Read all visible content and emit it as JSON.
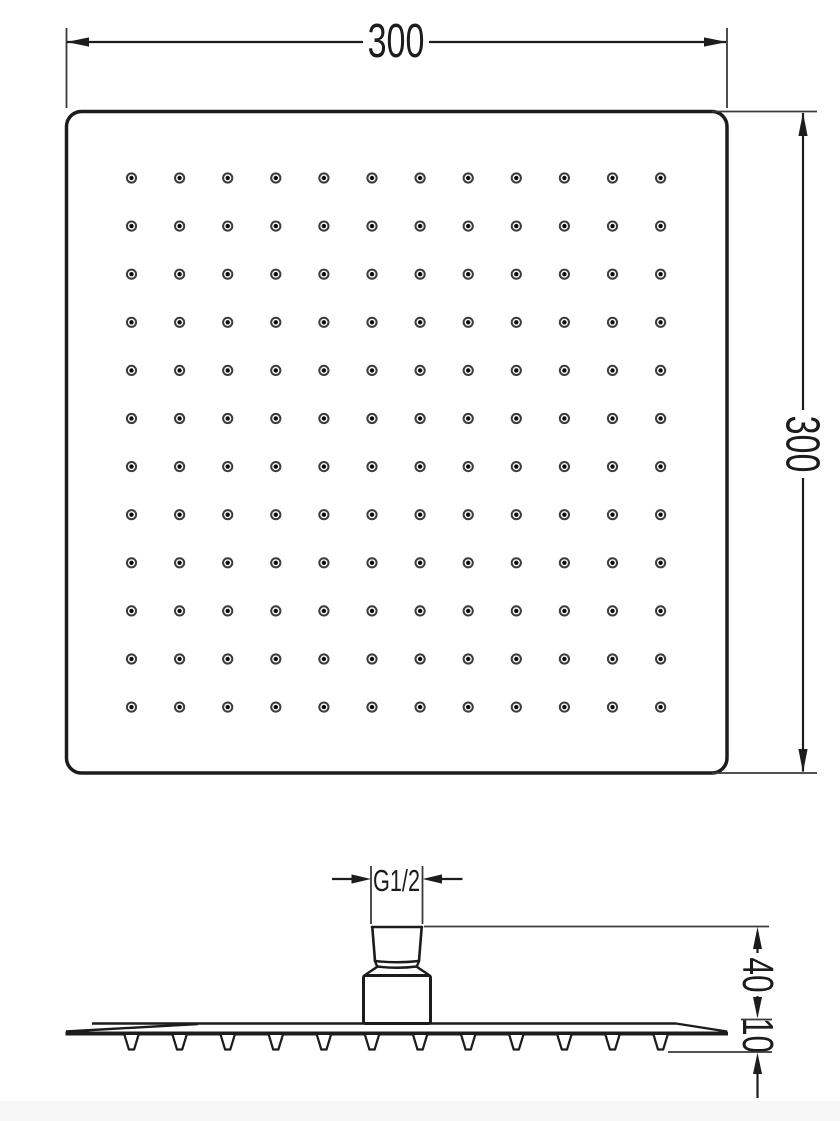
{
  "meta": {
    "type": "technical-drawing",
    "subject": "Square rain shower head - dimensional drawing (top view and side view)"
  },
  "colors": {
    "line": "#1c1c1c",
    "background": "#ffffff",
    "nozzle_ring": "#3c3c3c",
    "nozzle_dot": "#0d0d0d",
    "extension_line": "#3a3a3a",
    "bottom_band": "#f6f6f6"
  },
  "labels": {
    "width": "300",
    "height": "300",
    "thread": "G1/2",
    "connector_height": "40",
    "plate_thickness": "10"
  },
  "top_view": {
    "nozzle_grid": {
      "rows": 12,
      "cols": 12,
      "start_x": 131.5,
      "start_y": 178,
      "spacing_x": 48.1,
      "spacing_y": 48.1,
      "outer_radius": 4.6,
      "ring_width": 2,
      "dot_radius": 2.2
    }
  },
  "side_view": {
    "stubs": {
      "count": 12,
      "start_x": 131.5,
      "spacing": 48.1,
      "top_y": 1035,
      "bottom_y": 1049.5,
      "top_half_width": 7,
      "bottom_half_width": 2.6
    }
  }
}
